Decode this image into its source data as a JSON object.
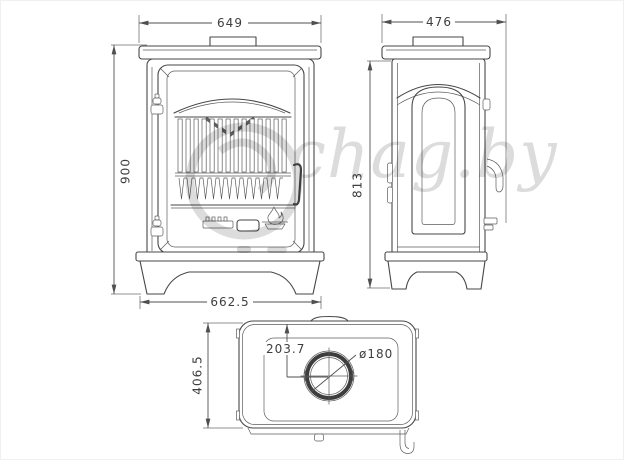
{
  "watermark": {
    "text": "chag.by"
  },
  "dims": {
    "front_width": "649",
    "front_height": "900",
    "front_base_width": "662.5",
    "side_depth": "476",
    "side_height": "813",
    "top_depth": "406.5",
    "flue_offset": "203.7",
    "flue_diameter": "ø180"
  },
  "colors": {
    "line": "#474747",
    "dim_text": "#3e3e3e",
    "watermark": "#d6d6d6",
    "background": "#ffffff"
  }
}
